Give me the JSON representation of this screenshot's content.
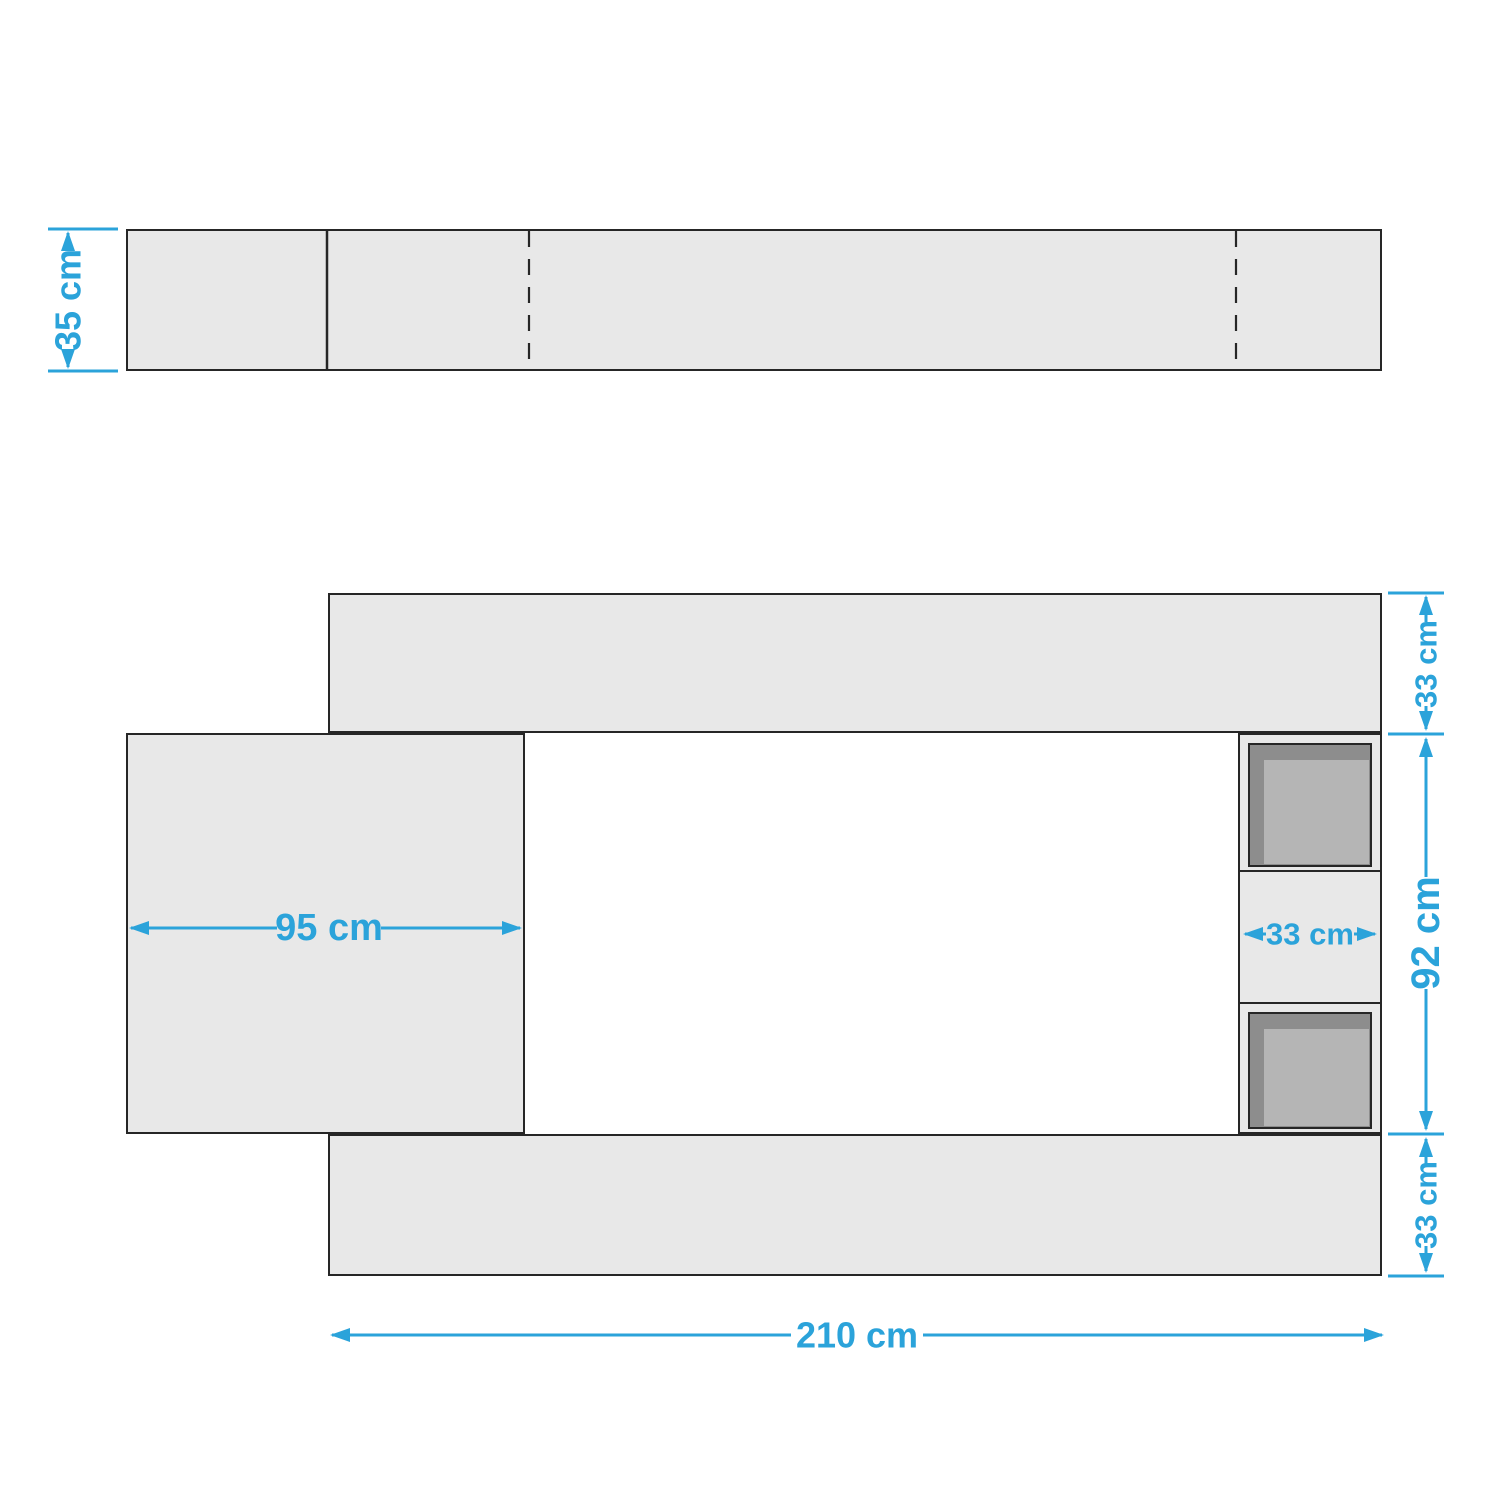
{
  "colors": {
    "accent": "#2ba3da",
    "panel": "#e8e8e8",
    "stroke": "#262626",
    "cubby_dark": "#8d8d8d",
    "cubby_inner": "#b5b5b5"
  },
  "labels": {
    "top_view_depth": "35 cm",
    "front_top_shelf": "33 cm",
    "front_height": "92 cm",
    "front_bottom_shelf": "33 cm",
    "front_left_panel_width": "95 cm",
    "front_cubby_width": "33 cm",
    "front_total_width": "210 cm"
  }
}
